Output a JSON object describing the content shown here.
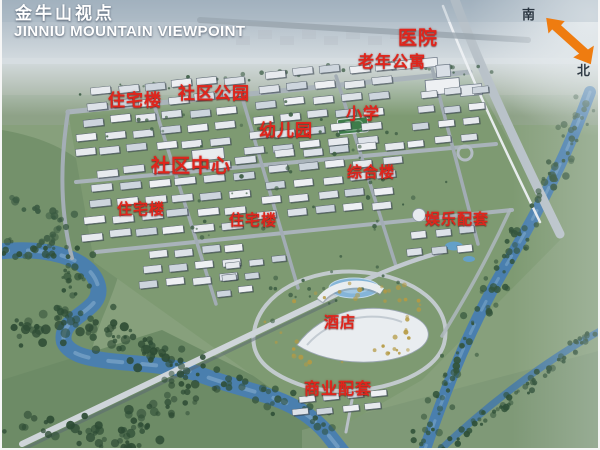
{
  "title": {
    "zh": "金牛山视点",
    "en": "JINNIU MOUNTAIN VIEWPOINT"
  },
  "compass": {
    "south": "南",
    "north": "北"
  },
  "map_labels": [
    {
      "id": "hospital",
      "text": "医院",
      "x": 396,
      "y": 29,
      "size": 19
    },
    {
      "id": "elderly-apartments",
      "text": "老年公寓",
      "x": 356,
      "y": 55,
      "size": 16
    },
    {
      "id": "residential-1",
      "text": "住宅楼",
      "x": 106,
      "y": 92,
      "size": 17
    },
    {
      "id": "community-park",
      "text": "社区公园",
      "x": 176,
      "y": 85,
      "size": 17
    },
    {
      "id": "kindergarten",
      "text": "幼儿园",
      "x": 257,
      "y": 122,
      "size": 17
    },
    {
      "id": "primary-school",
      "text": "小学",
      "x": 344,
      "y": 107,
      "size": 16
    },
    {
      "id": "community-center",
      "text": "社区中心",
      "x": 149,
      "y": 157,
      "size": 19
    },
    {
      "id": "complex-building",
      "text": "综合楼",
      "x": 345,
      "y": 165,
      "size": 15
    },
    {
      "id": "residential-2",
      "text": "住宅楼",
      "x": 115,
      "y": 202,
      "size": 15
    },
    {
      "id": "residential-3",
      "text": "住宅楼",
      "x": 227,
      "y": 213,
      "size": 15
    },
    {
      "id": "entertainment",
      "text": "娱乐配套",
      "x": 423,
      "y": 212,
      "size": 15
    },
    {
      "id": "hotel",
      "text": "酒店",
      "x": 322,
      "y": 315,
      "size": 15
    },
    {
      "id": "commercial",
      "text": "商业配套",
      "x": 302,
      "y": 382,
      "size": 16
    }
  ],
  "colors": {
    "label_red": "#e0251c",
    "arrow_orange": "#ef7c10",
    "title_white": "#ffffff",
    "river_blue": "#4a7fae",
    "site_green": "#7e9a72"
  }
}
